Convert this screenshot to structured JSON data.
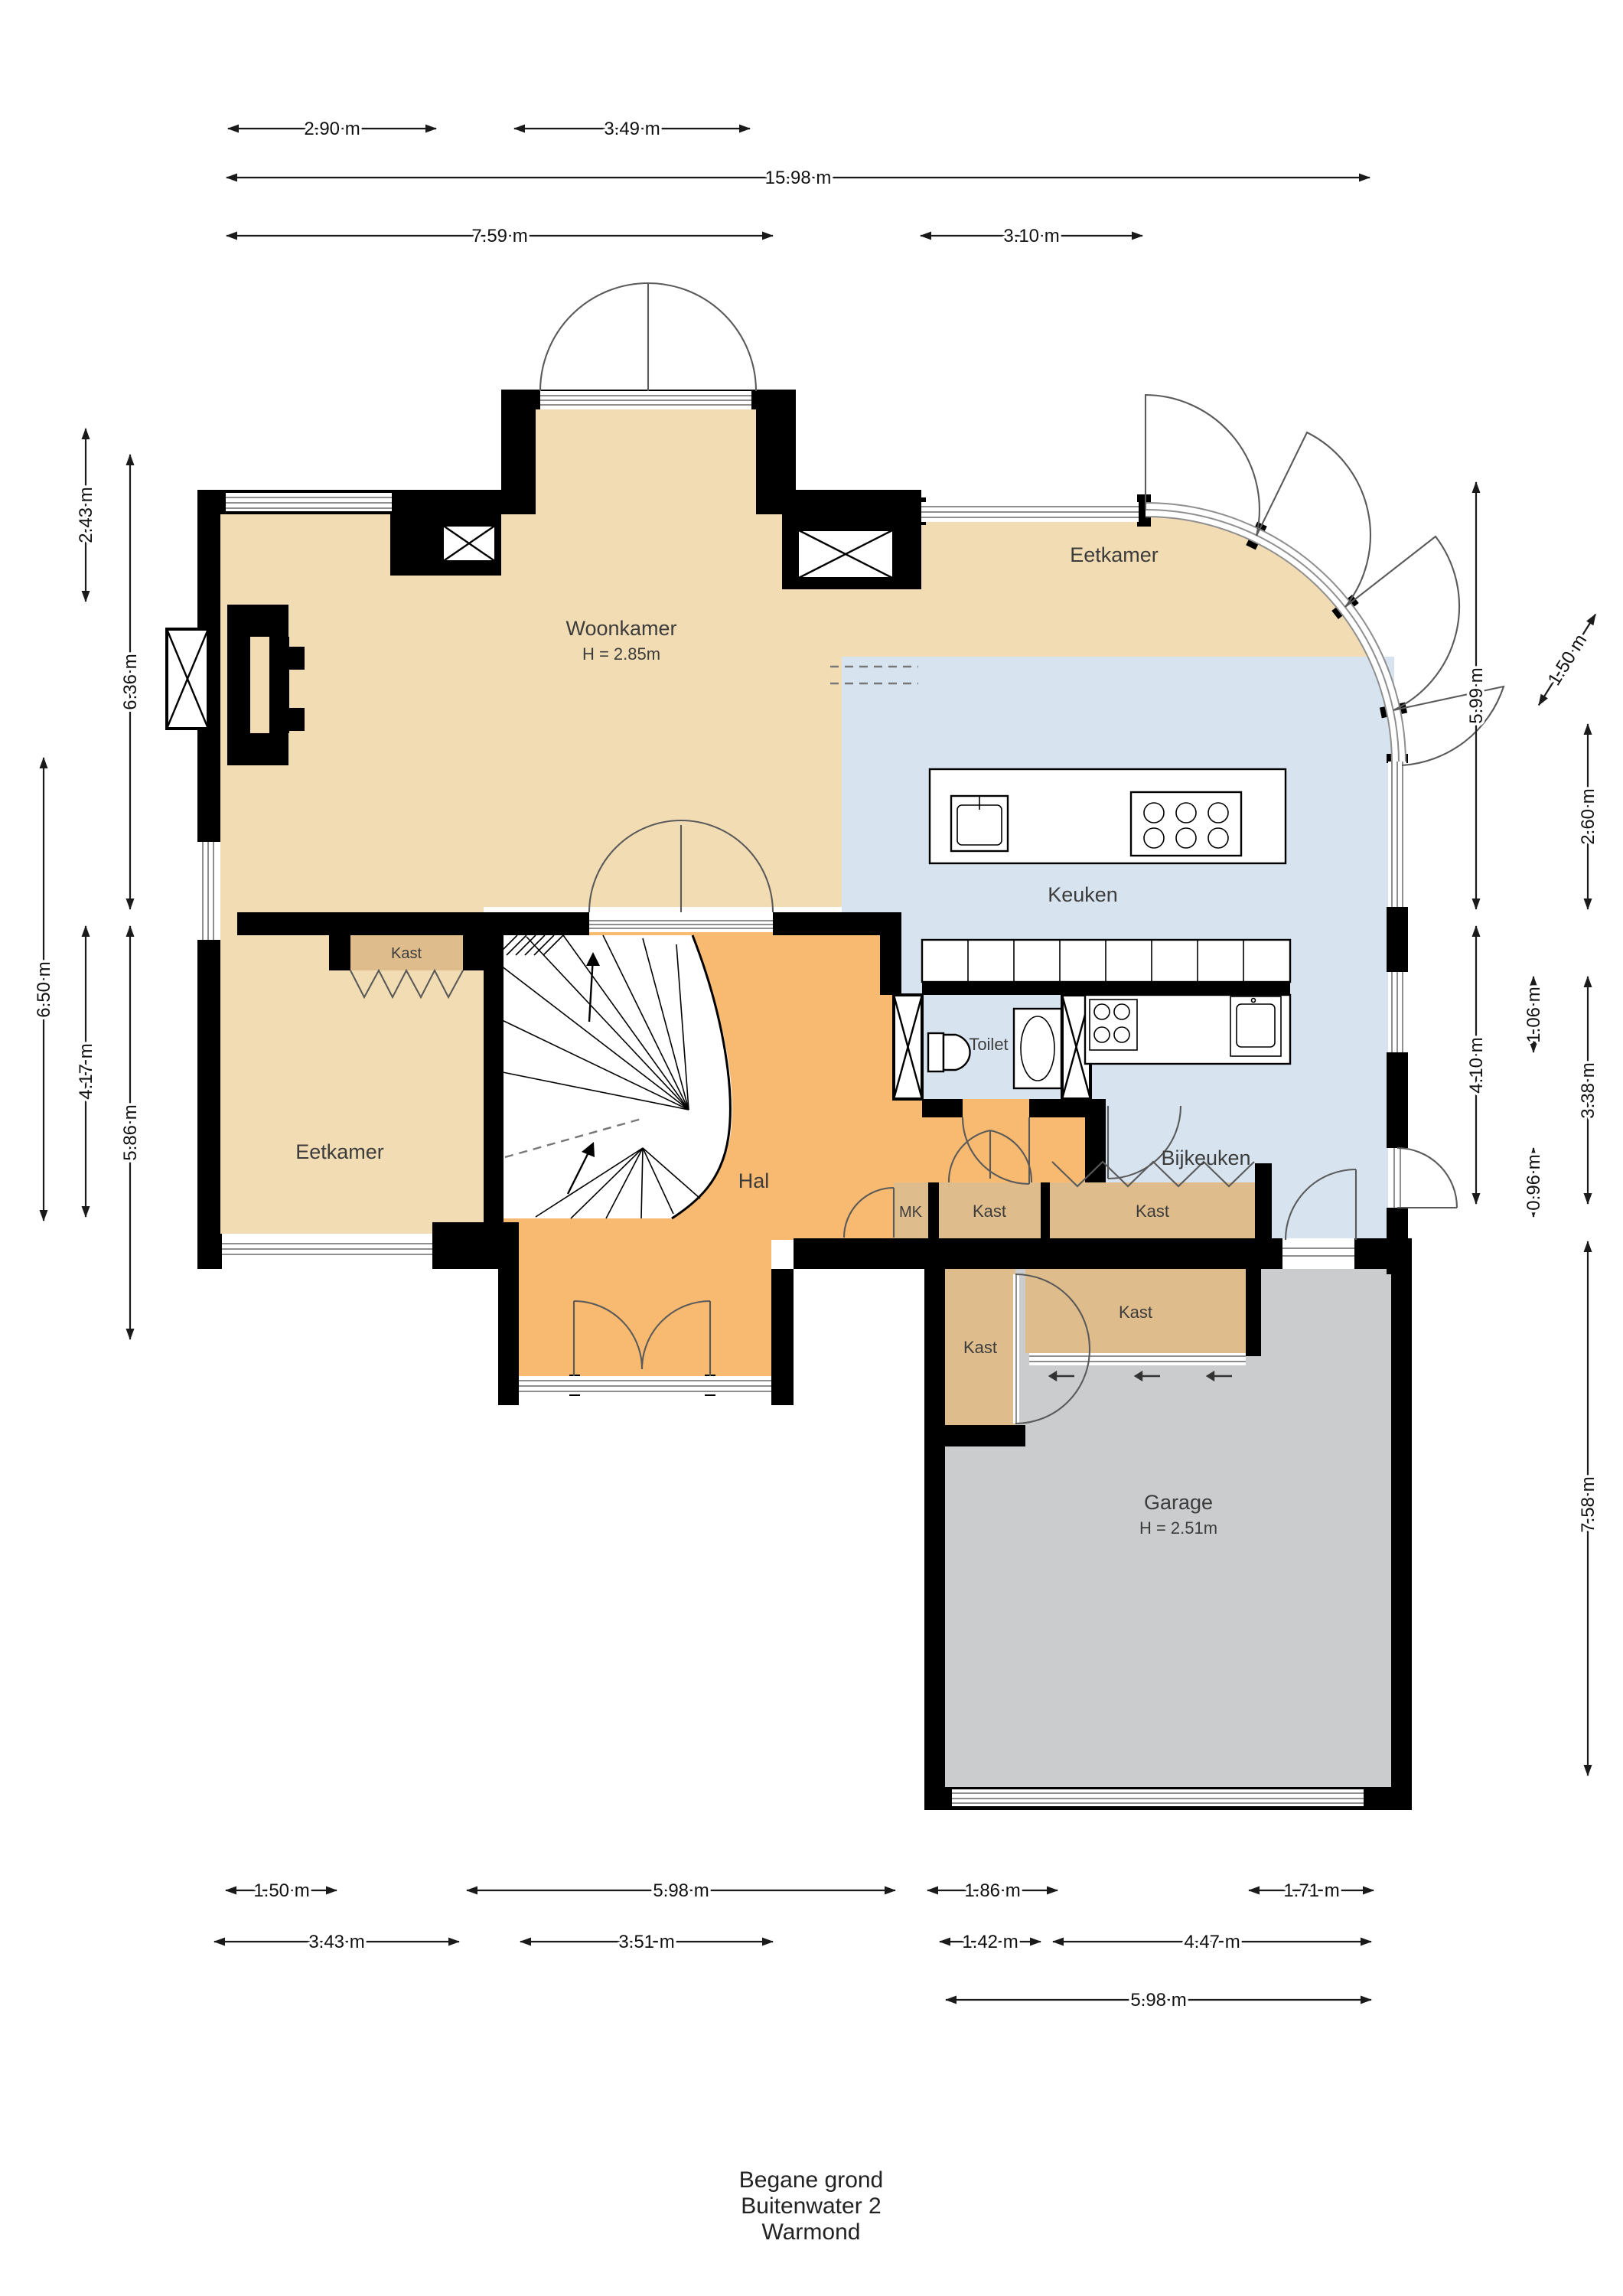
{
  "title_block": {
    "line1": "Begane grond",
    "line2": "Buitenwater 2",
    "line3": "Warmond"
  },
  "rooms": {
    "woonkamer": {
      "label": "Woonkamer",
      "height_note": "H = 2.85m"
    },
    "eetkamer_top": {
      "label": "Eetkamer"
    },
    "keuken": {
      "label": "Keuken"
    },
    "eetkamer_left": {
      "label": "Eetkamer"
    },
    "hal": {
      "label": "Hal"
    },
    "toilet": {
      "label": "Toilet"
    },
    "bijkeuken": {
      "label": "Bijkeuken"
    },
    "mk": {
      "label": "MK"
    },
    "kast_eetkamer": {
      "label": "Kast"
    },
    "kast_hal": {
      "label": "Kast"
    },
    "kast_bijkeuken": {
      "label": "Kast"
    },
    "kast_garage_tall": {
      "label": "Kast"
    },
    "kast_garage_wide": {
      "label": "Kast"
    },
    "garage": {
      "label": "Garage",
      "height_note": "H = 2.51m"
    }
  },
  "dimensions": {
    "top": [
      "2.90 m",
      "3.49 m",
      "15.98 m",
      "7.59 m",
      "3.10 m"
    ],
    "left": [
      "2.43 m",
      "6.36 m",
      "6.50 m",
      "4.17 m",
      "5.86 m"
    ],
    "right": [
      "5.99 m",
      "4.10 m",
      "1.06 m",
      "0.96 m",
      "2.60 m",
      "3.38 m",
      "7.58 m",
      "1.50 m"
    ],
    "bottom": [
      "1.50 m",
      "5.98 m",
      "1.86 m",
      "1.71 m",
      "3.43 m",
      "3.51 m",
      "1.42 m",
      "4.47 m",
      "5.98 m"
    ]
  },
  "colors": {
    "room_beige": "#F2DCB3",
    "hal_orange": "#F7BA70",
    "closet_tan": "#DEBC8C",
    "kitchen_blue": "#D7E4F0",
    "garage_gray": "#CBCCCD",
    "wall_black": "#000000"
  }
}
